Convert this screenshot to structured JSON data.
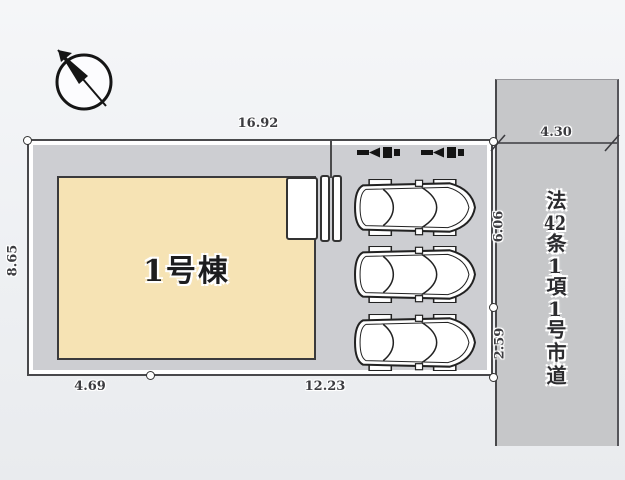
{
  "diagram": {
    "type": "site-plan",
    "compass": {
      "icon": "north-arrow"
    },
    "building": {
      "label": "1号棟",
      "fill": "#f6e3b4"
    },
    "dimensions": {
      "top_width": "16.92",
      "left_height": "8.65",
      "bottom_left": "4.69",
      "bottom_right": "12.23",
      "road_width": "4.30",
      "right_upper": "6.06",
      "right_lower": "2.59"
    },
    "road": {
      "label": "法42条1項1号市道",
      "fill": "#c6c7c9"
    },
    "parking": {
      "car_count": 3,
      "car_icon": "car-top-view",
      "entry_marker_icon": "entry-arrow",
      "entry_marker_count": 2
    },
    "colors": {
      "plot_fill": "#cdced2",
      "line": "#48484b",
      "background": "#eef0f3"
    }
  }
}
